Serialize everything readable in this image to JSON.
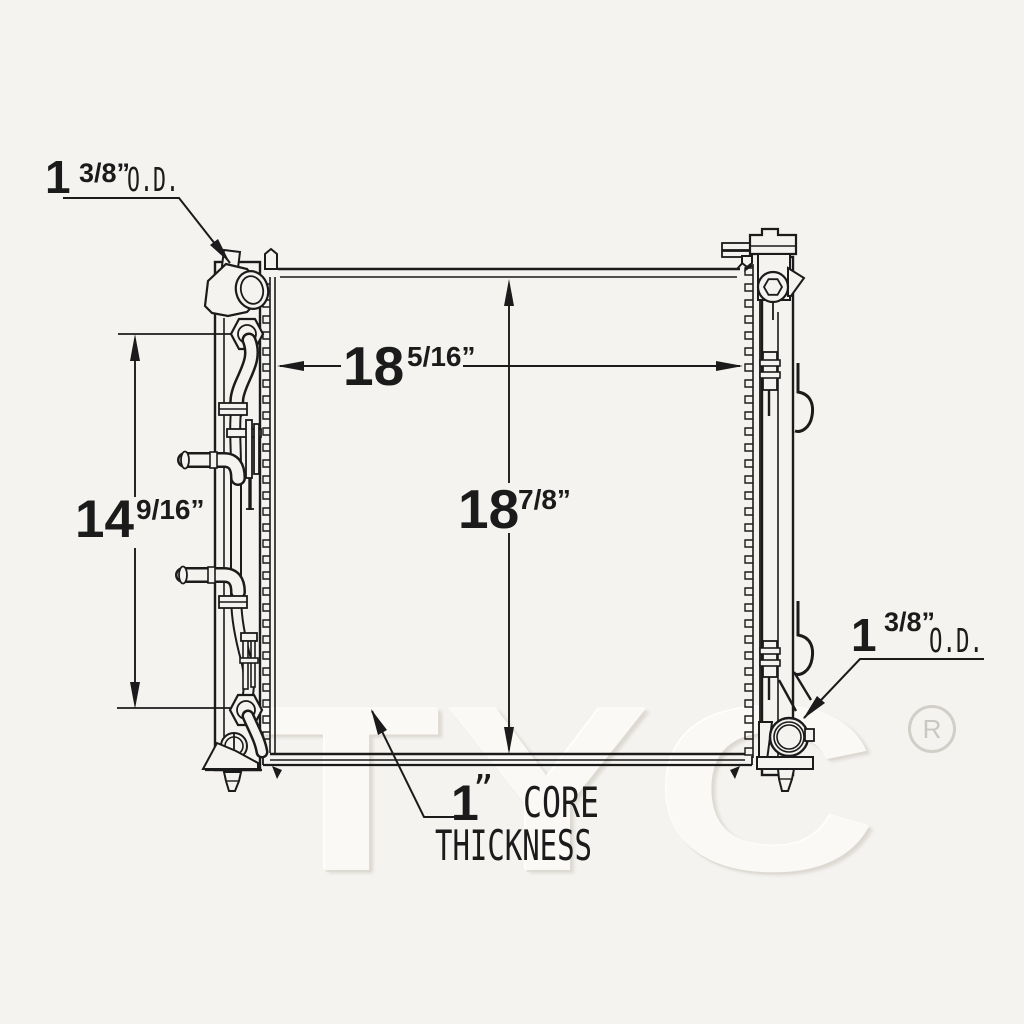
{
  "page": {
    "background_color": "#f4f3f0",
    "line_color": "#1b1b1b"
  },
  "watermark": {
    "text": "TYC",
    "registered_symbol": "R",
    "fill_color": "#faf9f6",
    "shadow_color": "#ddd9d2",
    "registered_color": "#cbc8c2"
  },
  "dimensions": {
    "inlet_od": {
      "whole": "1",
      "fraction": "3/8”",
      "suffix": "O.D."
    },
    "core_width": {
      "whole": "18",
      "fraction": "5/16”"
    },
    "core_height": {
      "whole": "18",
      "fraction": "7/8”"
    },
    "port_span": {
      "whole": "14",
      "fraction": "9/16”"
    },
    "outlet_od": {
      "whole": "1",
      "fraction": "3/8”",
      "suffix": "O.D."
    },
    "core_thickness": {
      "whole": "1",
      "quote": "”",
      "label_line1": "CORE",
      "label_line2": "THICKNESS"
    }
  }
}
